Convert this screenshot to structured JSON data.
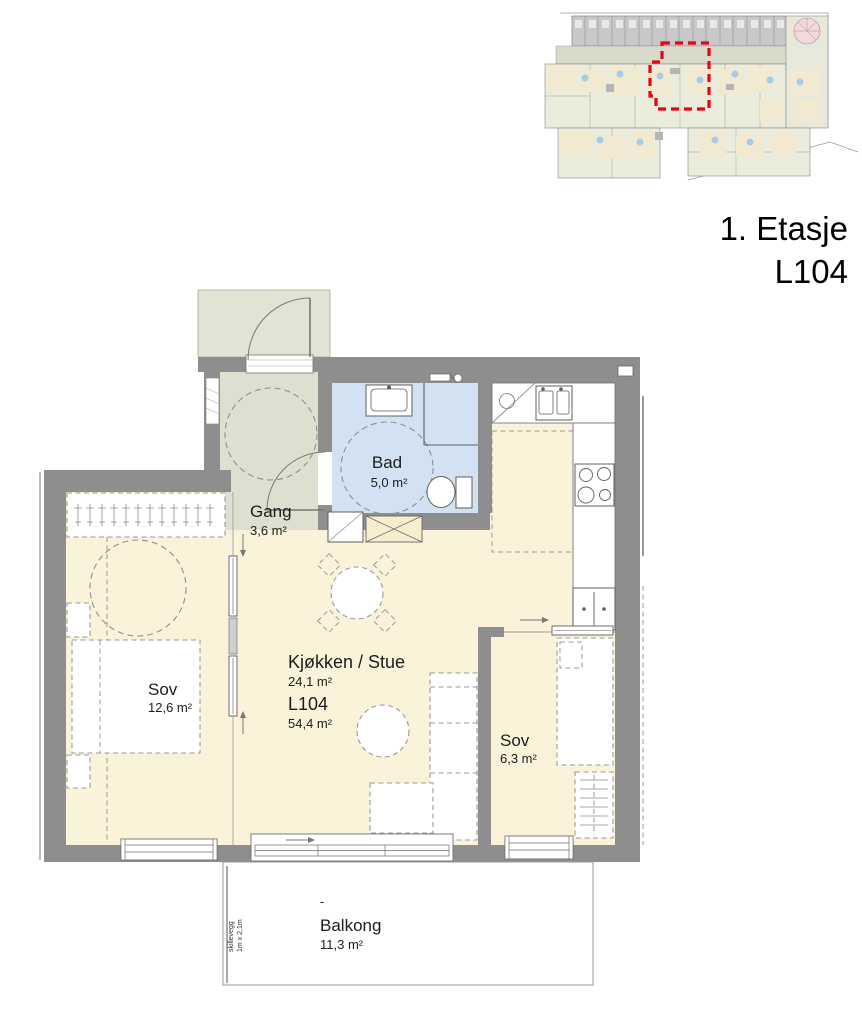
{
  "title": {
    "floor": "1. Etasje",
    "unit": "L104"
  },
  "overview": {
    "highlighted_unit": "L104",
    "highlight_color": "#e30613"
  },
  "rooms": {
    "gang": {
      "name": "Gang",
      "area": "3,6 m²"
    },
    "bad": {
      "name": "Bad",
      "area": "5,0 m²"
    },
    "sov1": {
      "name": "Sov",
      "area": "12,6 m²"
    },
    "stue": {
      "name": "Kjøkken / Stue",
      "area": "24,1 m²",
      "unit": "L104",
      "unit_area": "54,4 m²"
    },
    "sov2": {
      "name": "Sov",
      "area": "6,3 m²"
    },
    "balkong": {
      "name": "Balkong",
      "area": "11,3 m²",
      "dash": "-",
      "partition_l1": "skillevegg",
      "partition_l2": "1m x 2,1m"
    }
  },
  "colors": {
    "wall": "#8e8e8e",
    "floor": "#faf3da",
    "hall_floor": "#dfdfd1",
    "bath_floor": "#d2e2f2",
    "entry_landing": "#e3e3d5",
    "highlight": "#e30613"
  }
}
